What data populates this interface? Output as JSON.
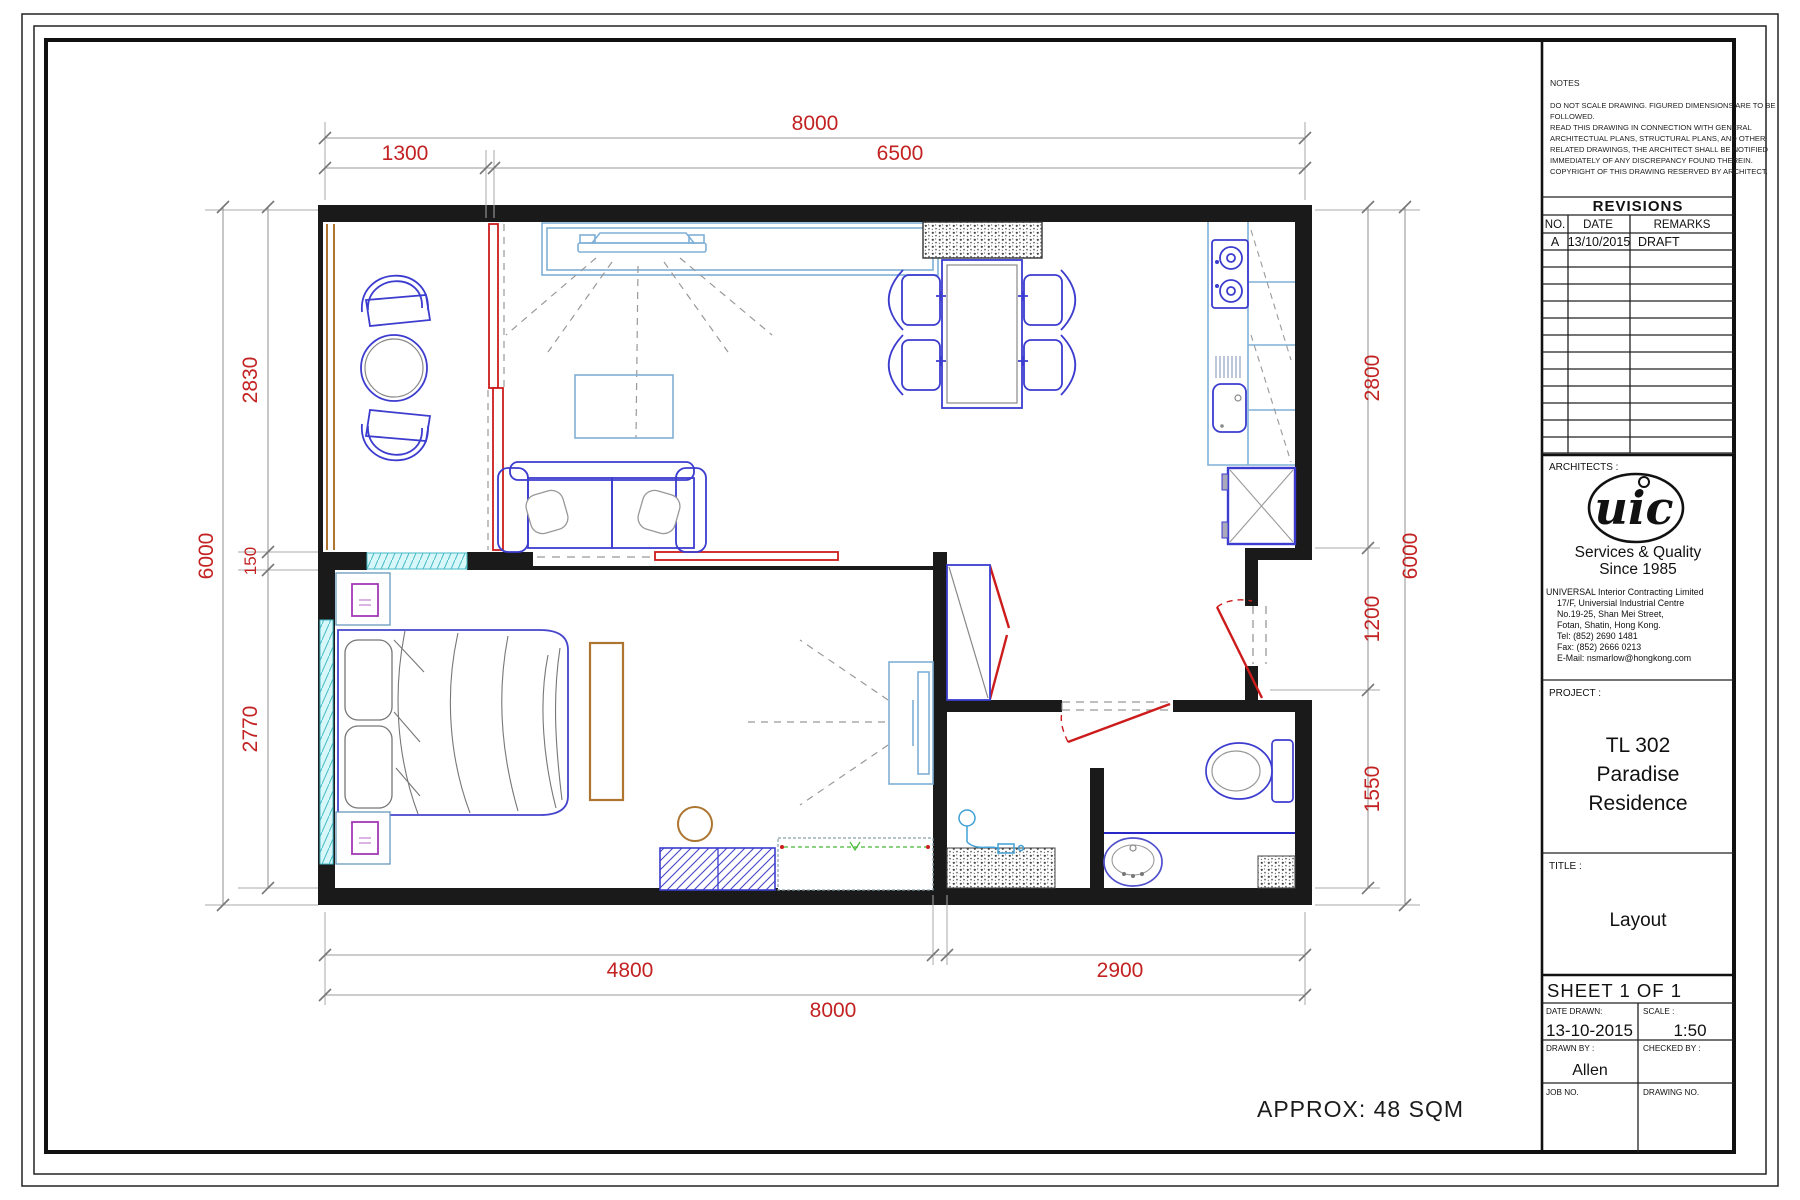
{
  "sheet_type": "architectural-floor-plan",
  "notes": {
    "label": "NOTES",
    "lines": [
      "DO NOT SCALE DRAWING. FIGURED DIMENSIONS ARE TO BE",
      "FOLLOWED.",
      "READ THIS DRAWING IN CONNECTION WITH GENERAL",
      "ARCHITECTUAL PLANS, STRUCTURAL PLANS, AND OTHER",
      "RELATED DRAWINGS, THE ARCHITECT SHALL BE NOTIFIED",
      "IMMEDIATELY OF ANY DISCREPANCY FOUND THEREIN.",
      "COPYRIGHT OF THIS DRAWING RESERVED BY ARCHITECT."
    ]
  },
  "revisions": {
    "title": "REVISIONS",
    "columns": [
      "NO.",
      "DATE",
      "REMARKS"
    ],
    "rows": [
      {
        "no": "A",
        "date": "13/10/2015",
        "remarks": "DRAFT"
      }
    ],
    "empty_row_count": 12
  },
  "architects": {
    "label": "ARCHITECTS :",
    "logo_text": "uic",
    "tagline_line1": "Services & Quality",
    "tagline_line2": "Since 1985",
    "address_lines": [
      "UNIVERSAL Interior Contracting Limited",
      "17/F, Universial Industrial Centre",
      "No.19-25, Shan Mei Street,",
      "Fotan, Shatin, Hong Kong.",
      "Tel: (852) 2690 1481",
      "Fax: (852) 2666 0213",
      "E-Mail: nsmarlow@hongkong.com"
    ]
  },
  "project": {
    "label": "PROJECT :",
    "name_lines": [
      "TL 302",
      "Paradise",
      "Residence"
    ]
  },
  "title_block": {
    "title_label": "TITLE :",
    "title_value": "Layout",
    "sheet_label": "SHEET 1 OF 1",
    "date_drawn_label": "DATE DRAWN:",
    "date_drawn_value": "13-10-2015",
    "scale_label": "SCALE :",
    "scale_value": "1:50",
    "drawn_by_label": "DRAWN BY :",
    "drawn_by_value": "Allen",
    "checked_by_label": "CHECKED BY :",
    "job_no_label": "JOB NO.",
    "drawing_no_label": "DRAWING NO."
  },
  "plan": {
    "approx_area": "APPROX: 48 SQM",
    "dimensions": {
      "top_overall": "8000",
      "top_balcony": "1300",
      "top_living": "6500",
      "left_overall": "6000",
      "left_upper": "2830",
      "left_wall": "150",
      "left_lower": "2770",
      "right_overall": "6000",
      "right_kitchen": "2800",
      "right_entry": "1200",
      "right_bath": "1550",
      "bottom_bedroom": "4800",
      "bottom_bath": "2900",
      "bottom_overall": "8000"
    },
    "colors": {
      "dimension_text": "#c32222",
      "walls": "#1a1a1a",
      "furniture": "#3c3ccf",
      "fixtures_light": "#7fb0d6",
      "window": "#aeeef2",
      "wood": "#ad752f",
      "door": "#cc1c1c",
      "accent_purple": "#a438b8",
      "accent_green": "#44bb33"
    }
  }
}
